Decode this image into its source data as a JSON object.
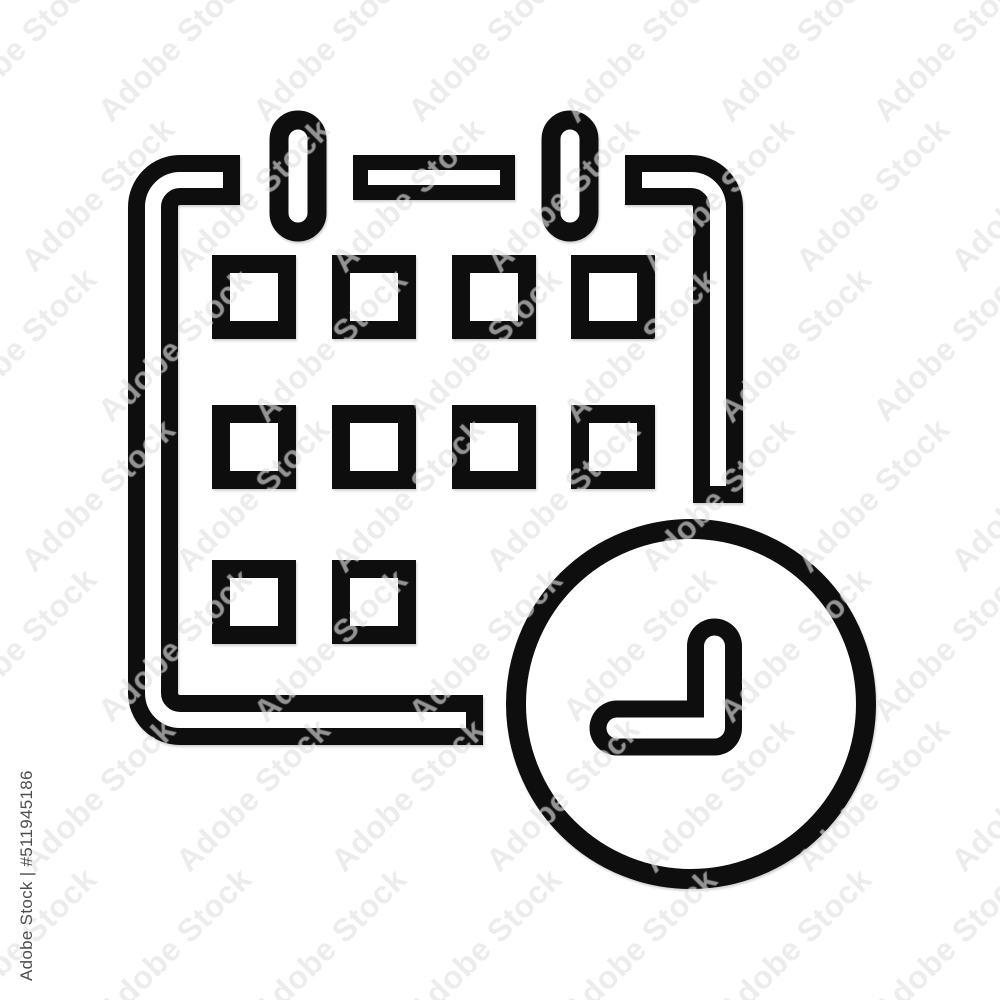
{
  "page": {
    "background": "#ffffff"
  },
  "image": {
    "subject": "calendar with clock line icon",
    "ink_color": "#0e0e0f"
  },
  "watermark": {
    "tile_text": "Adobe Stock",
    "tile_color": "rgba(70,70,70,0.10)",
    "corner_label": "Adobe Stock | #511945186",
    "corner_color": "#4d4d4d"
  }
}
